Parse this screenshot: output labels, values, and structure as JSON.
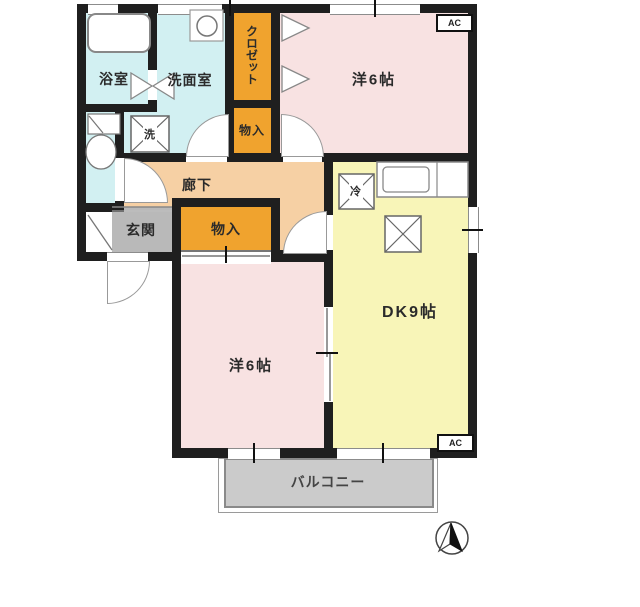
{
  "plan": {
    "type": "apartment-floor-plan",
    "rooms": {
      "bath": {
        "label": "浴室"
      },
      "washroom": {
        "label": "洗面室"
      },
      "toilet": {
        "label": ""
      },
      "closet": {
        "label": "クロゼット"
      },
      "storage_upper": {
        "label": "物入"
      },
      "western_room_top": {
        "label": "洋6帖"
      },
      "hallway": {
        "label": "廊下"
      },
      "entrance": {
        "label": "玄関"
      },
      "storage_lower": {
        "label": "物入"
      },
      "western_room_bottom": {
        "label": "洋6帖"
      },
      "dining_kitchen": {
        "label": "DK9帖"
      },
      "balcony": {
        "label": "バルコニー"
      }
    },
    "fixtures": {
      "washing_machine": {
        "label": "洗"
      },
      "refrigerator": {
        "label": "冷"
      }
    },
    "ac_units": {
      "top_right": "AC",
      "bottom_right": "AC"
    },
    "colors": {
      "wall": "#1f1f1f",
      "wet_area": "#d2f0f2",
      "storage": "#f0a32e",
      "hallway": "#f6d0a4",
      "entrance": "#b9b9b9",
      "western_room": "#f8e2e2",
      "dining_kitchen": "#f8f5b8",
      "balcony": "#cbcbcb"
    }
  }
}
